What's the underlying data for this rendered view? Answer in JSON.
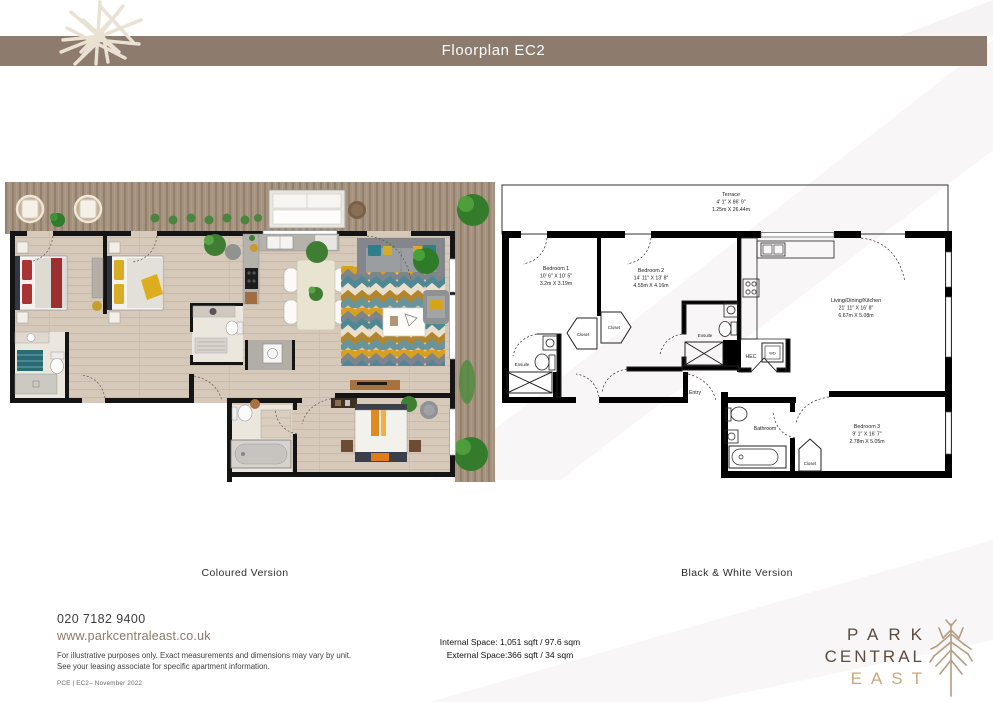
{
  "header": {
    "title": "Floorplan EC2"
  },
  "version_labels": {
    "coloured": "Coloured Version",
    "bw": "Black & White Version"
  },
  "rooms": {
    "terrace": {
      "name": "Terrace",
      "imperial": "4' 1\" X 86' 9\"",
      "metric": "1.25m X 26.44m"
    },
    "bedroom1": {
      "name": "Bedroom 1",
      "imperial": "10' 6\" X 10' 5\"",
      "metric": "3.2m X 3.19m"
    },
    "bedroom2": {
      "name": "Bedroom 2",
      "imperial": "14' 11\" X 13' 8\"",
      "metric": "4.55m X 4.16m"
    },
    "living": {
      "name": "Living/Dining/Kitchen",
      "imperial": "21' 11\" X 16' 8\"",
      "metric": "6.67m X 5.08m"
    },
    "bedroom3": {
      "name": "Bedroom 3",
      "imperial": "9' 1\" X 16' 7\"",
      "metric": "2.78m X 5.05m"
    }
  },
  "labels": {
    "bathroom": "Bathroom",
    "ensuite_a": "Ensuite",
    "ensuite_b": "Ensuite",
    "closet_hall_a": "Closet",
    "closet_hall_b": "Closet",
    "closet_bed3": "Closet",
    "hec": "HEC",
    "wd": "WD",
    "entry": "Entry"
  },
  "areas": {
    "internal": "Internal Space: 1,051 sqft / 97.6 sqm",
    "external": "External Space:366 sqft / 34 sqm"
  },
  "contact": {
    "phone": "020 7182 9400",
    "website": "www.parkcentraleast.co.uk"
  },
  "disclaimer": {
    "line1": "For illustrative purposes only. Exact measurements and dimensions may vary by unit.",
    "line2": "See your leasing associate for specific apartment information."
  },
  "doc_ref": "PCE | EC2– November 2022",
  "brand": {
    "line1": "PARK",
    "line2": "CENTRAL",
    "line3": "EAST"
  },
  "colors": {
    "header_bar": "#8d7b6d",
    "brand_dark": "#5c4c40",
    "brand_gold": "#c9a97c",
    "link": "#8b7a6a"
  }
}
